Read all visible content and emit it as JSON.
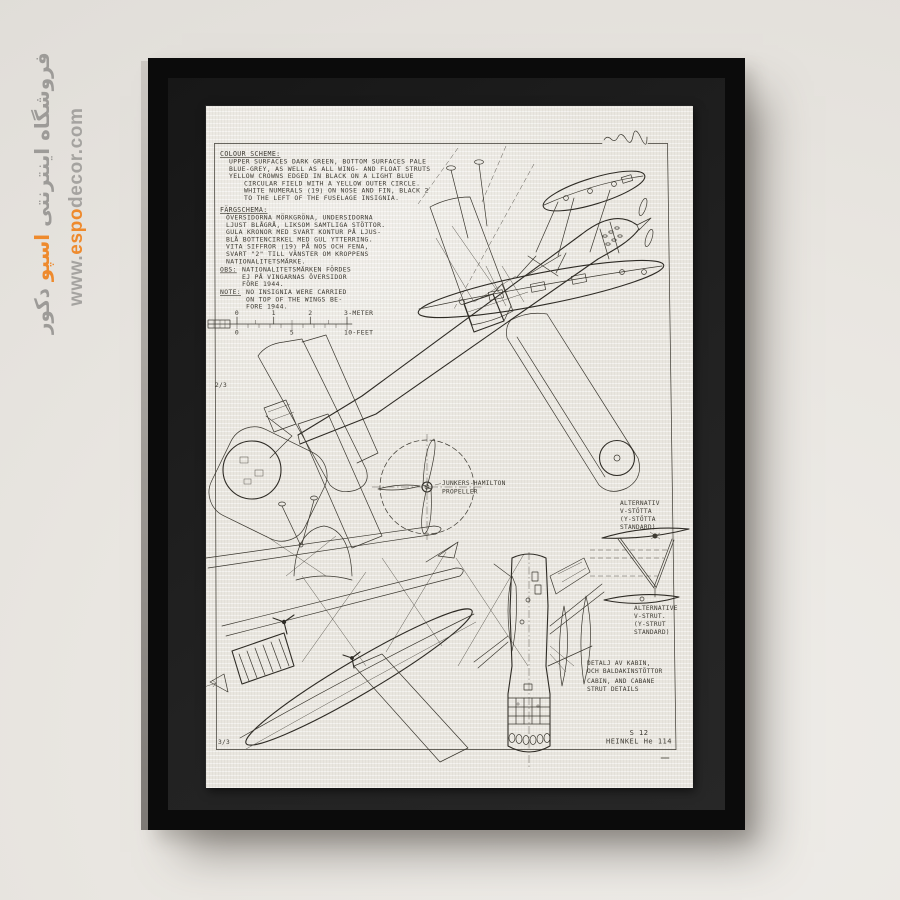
{
  "watermark": {
    "store_name_pre": "فروشگاه اینترنتی",
    "store_name_highlight": "اسپو",
    "store_name_post": "دکور",
    "url_pre": "www.",
    "url_highlight": "espo",
    "url_post": "decor.com",
    "grey_color": "#9d9b98",
    "accent_color": "#ee8a2d"
  },
  "poster": {
    "sheet_upper": "2/3",
    "sheet_lower": "3/3",
    "colour_scheme": {
      "title": "COLOUR SCHEME:",
      "lines": [
        "UPPER SURFACES DARK GREEN, BOTTOM SURFACES PALE",
        "BLUE-GREY, AS WELL AS ALL WING- AND FLOAT STRUTS",
        "YELLOW CROWNS EDGED IN BLACK ON A LIGHT BLUE",
        "CIRCULAR FIELD WITH A YELLOW OUTER CIRCLE.",
        "WHITE NUMERALS (19) ON NOSE AND FIN, BLACK 2",
        "TO THE LEFT OF THE FUSELAGE INSIGNIA."
      ]
    },
    "fargschema": {
      "title": "FÄRGSCHEMA:",
      "lines": [
        "ÖVERSIDORNA MÖRKGRÖNA, UNDERSIDORNA",
        "LJUST BLÅGRÅ, LIKSOM SAMTLIGA STÖTTOR.",
        "GULA KRONOR MED SVART KONTUR PÅ LJUS-",
        "BLÅ BOTTENCIRKEL MED GUL YTTERRING.",
        "VITA SIFFROR (19) PÅ NOS OCH FENA,",
        "SVART \"2\" TILL VÄNSTER OM KROPPENS",
        "NATIONALITETSMÄRKE."
      ]
    },
    "obs": {
      "label": "OBS:",
      "lines": [
        "NATIONALITETSMÄRKEN FÖRDES",
        "EJ PÅ VINGARNAS ÖVERSIDOR",
        "FÖRE 1944."
      ]
    },
    "note": {
      "label": "NOTE:",
      "lines": [
        "NO INSIGNIA WERE CARRIED",
        "ON TOP OF THE WINGS BE-",
        "FORE 1944."
      ]
    },
    "scale": {
      "meter_ticks": [
        "0",
        "1",
        "2"
      ],
      "meter_label": "3-METER",
      "feet_ticks": [
        "0",
        "5"
      ],
      "feet_label": "10-FEET"
    },
    "propeller_label": [
      "JUNKERS-HAMILTON",
      "PROPELLER"
    ],
    "strut_label_sv": [
      "ALTERNATIV",
      "V-STÖTTA",
      "(Y-STÖTTA",
      "STANDARD)"
    ],
    "strut_label_en": [
      "ALTERNATIVE",
      "V-STRUT.",
      "(Y-STRUT",
      "STANDARD)"
    ],
    "cabin_label": [
      "DETALJ AV KABIN,",
      "OCH BALDAKINSTÖTTOR",
      "CABIN, AND CABANE",
      "STRUT DETAILS"
    ],
    "title_block": {
      "model": "S 12",
      "name": "HEINKEL He 114"
    }
  }
}
